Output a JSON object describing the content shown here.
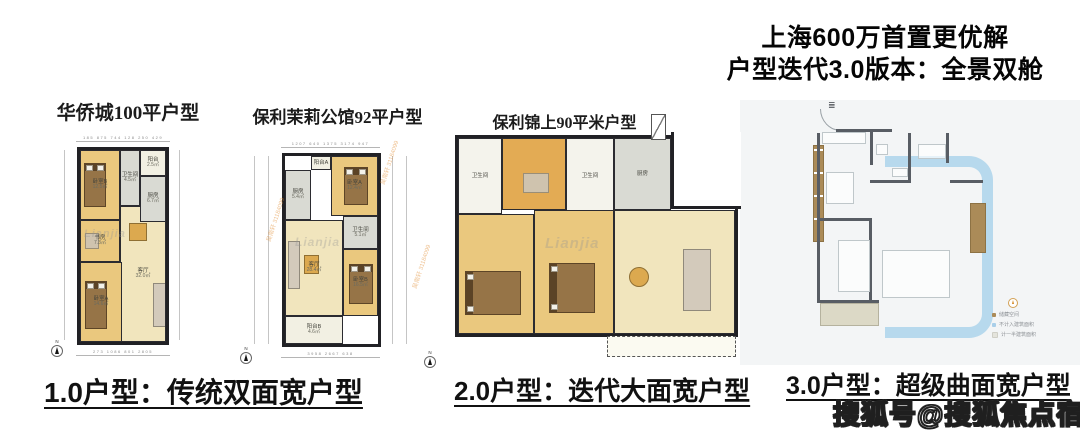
{
  "header": {
    "title_line1": "上海600万首置更优解",
    "title_line2": "户型迭代3.0版本：全景双舱"
  },
  "plans": [
    {
      "caption": "华侨城100平户型",
      "compass": "N",
      "brand_watermark": "Lianjia",
      "dims_top": "185  875  744  128  250  429",
      "dims_bottom": "273  1086  801  2805",
      "rooms": [
        {
          "name": "卧室B",
          "area": "12.5㎡"
        },
        {
          "name": "卫生间",
          "area": "4.5㎡"
        },
        {
          "name": "阳台",
          "area": "2.5㎡"
        },
        {
          "name": "厨房",
          "area": "6.7㎡"
        },
        {
          "name": "书房",
          "area": "7.3㎡"
        },
        {
          "name": "卧室A",
          "area": "14.6㎡"
        },
        {
          "name": "客厅",
          "area": "32.0㎡"
        }
      ]
    },
    {
      "caption": "保利茉莉公馆92平户型",
      "compass": "N",
      "brand_watermark": "Lianjia",
      "agent_watermark": "吴南轩 31184099",
      "dims_top": "1207  640  1375  3174  947",
      "dims_bottom": "3958  2667  638",
      "rooms": [
        {
          "name": "阳台A",
          "area": "1.9㎡"
        },
        {
          "name": "卧室A",
          "area": "12.4㎡"
        },
        {
          "name": "厨房",
          "area": "5.4㎡"
        },
        {
          "name": "客厅",
          "area": "28.4㎡"
        },
        {
          "name": "卫生间",
          "area": "5.1㎡"
        },
        {
          "name": "卧室B",
          "area": "16.5㎡"
        },
        {
          "name": "阳台B",
          "area": "4.6㎡"
        }
      ]
    },
    {
      "caption": "保利锦上90平米户型",
      "compass": "N",
      "brand_watermark": "Lianjia",
      "rooms": [
        {
          "name": "卫生间",
          "area": ""
        },
        {
          "name": "卫生间",
          "area": ""
        },
        {
          "name": "厨房",
          "area": ""
        }
      ]
    },
    {
      "legend": [
        {
          "label": "储藏空间",
          "color": "#ab8b58"
        },
        {
          "label": "不计入建筑面积",
          "color": "#a9cfe9"
        },
        {
          "label": "计一半建筑面积",
          "color": "#e4e4dc"
        }
      ]
    }
  ],
  "footer": {
    "captions": [
      "1.0户型：传统双面宽户型",
      "2.0户型：迭代大面宽户型",
      "3.0户型：超级曲面宽户型"
    ]
  },
  "site_watermark": "搜狐号@搜狐焦点宿州站",
  "colors": {
    "wall": "#212125",
    "bedroom_fill": "#eac87e",
    "living_fill": "#f1e5bd",
    "service_fill": "#d9dad3",
    "balcony_fill": "#f2f0e3",
    "plan4_wall": "#585d64",
    "plan4_blue": "#b7d9ed",
    "plan4_tan": "#ab8b58"
  }
}
